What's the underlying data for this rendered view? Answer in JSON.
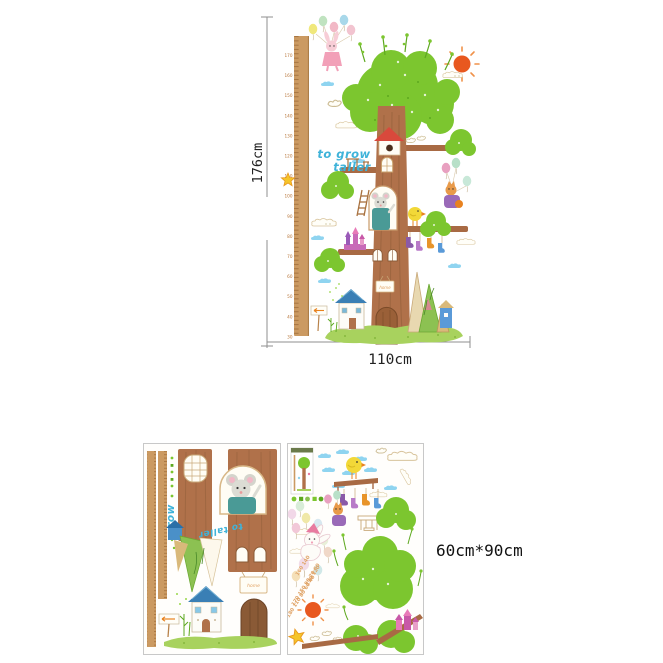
{
  "main_figure": {
    "height_label": "176cm",
    "width_label": "110cm",
    "slogan_line1": "to grow",
    "slogan_line2": "taller",
    "door_sign": "home",
    "ruler_labels": [
      "170",
      "160",
      "150",
      "140",
      "130",
      "120",
      "110",
      "100",
      "90",
      "80",
      "70",
      "60",
      "50",
      "40",
      "30"
    ]
  },
  "sheets": {
    "size_label": "60cm*90cm",
    "left_sheet": {
      "slogan_word1": "grow",
      "slogan_word2": "to taller",
      "door_sign": "home"
    },
    "right_sheet": {
      "number_rows": [
        "160 140",
        "130 120",
        "170 150 90 70 50",
        "180 110 80 60 40"
      ]
    }
  },
  "colors": {
    "foliage_green": "#7cc62f",
    "grass_green": "#a8d25e",
    "trunk_brown": "#b0714a",
    "ruler_tan": "#cb9a62",
    "cloud_blue": "#8fd4f0",
    "slogan_blue": "#3fb3d9",
    "sun_orange": "#e8581f",
    "roof_red": "#d9493c",
    "dimension_line_gray": "#8f8f8f",
    "sheet_border_gray": "#c8c8c8"
  }
}
